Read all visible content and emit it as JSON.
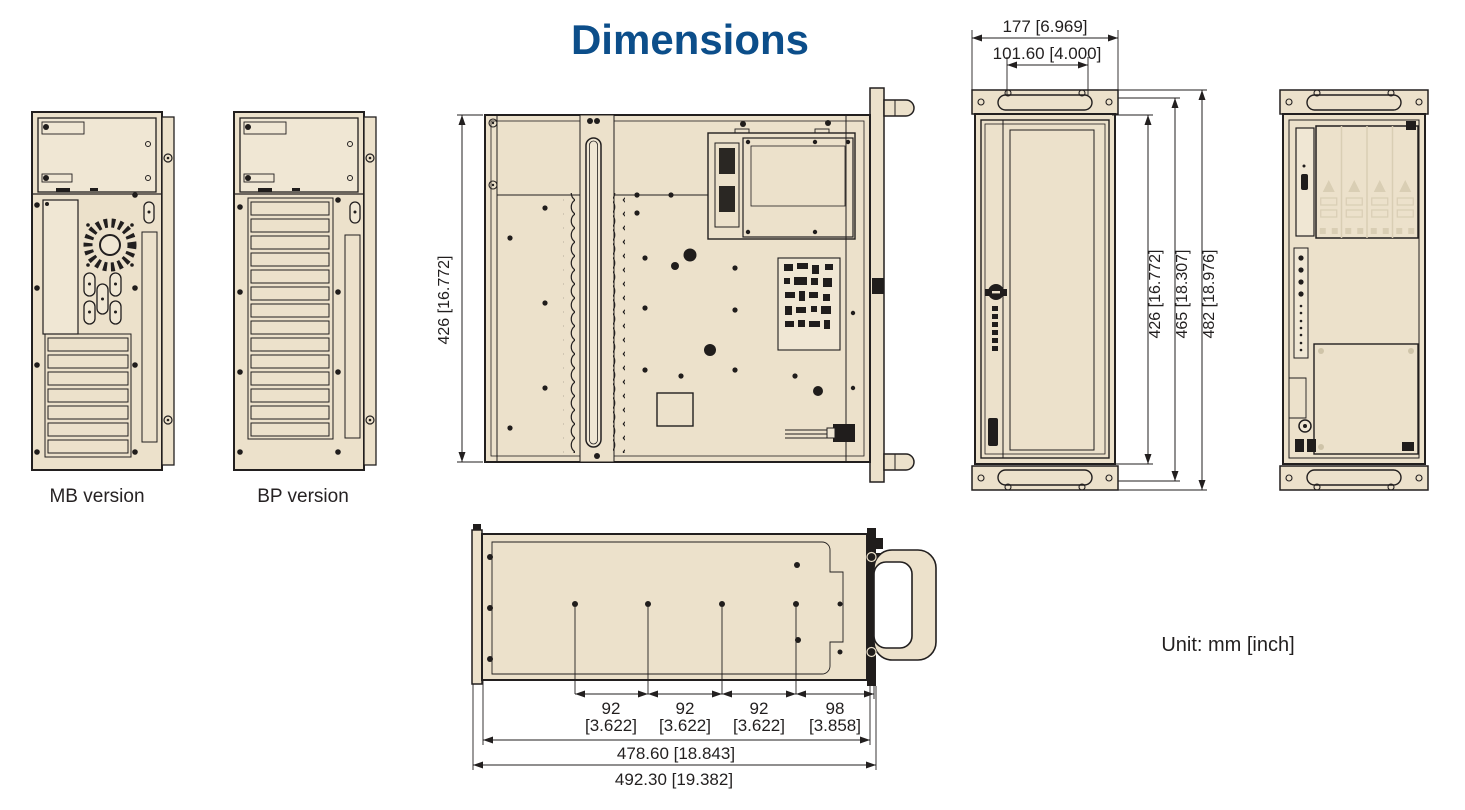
{
  "title": "Dimensions",
  "unit_label": "Unit: mm [inch]",
  "labels": {
    "mb": "MB version",
    "bp": "BP version"
  },
  "dims": {
    "front_width_outer": "177 [6.969]",
    "front_width_handle": "101.60 [4.000]",
    "top_depth": "426 [16.772]",
    "front_height_door": "426 [16.772]",
    "front_height_body": "465 [18.307]",
    "front_height_overall": "482 [18.976]",
    "bottom_seg1_mm": "92",
    "bottom_seg1_in": "[3.622]",
    "bottom_seg2_mm": "92",
    "bottom_seg2_in": "[3.622]",
    "bottom_seg3_mm": "92",
    "bottom_seg3_in": "[3.622]",
    "bottom_seg4_mm": "98",
    "bottom_seg4_in": "[3.858]",
    "bottom_width_body": "478.60 [18.843]",
    "bottom_width_overall": "492.30 [19.382]"
  },
  "colors": {
    "accent_blue": "#0c4e8a",
    "chassis_fill": "#ece1cb",
    "line": "#221f1f"
  }
}
